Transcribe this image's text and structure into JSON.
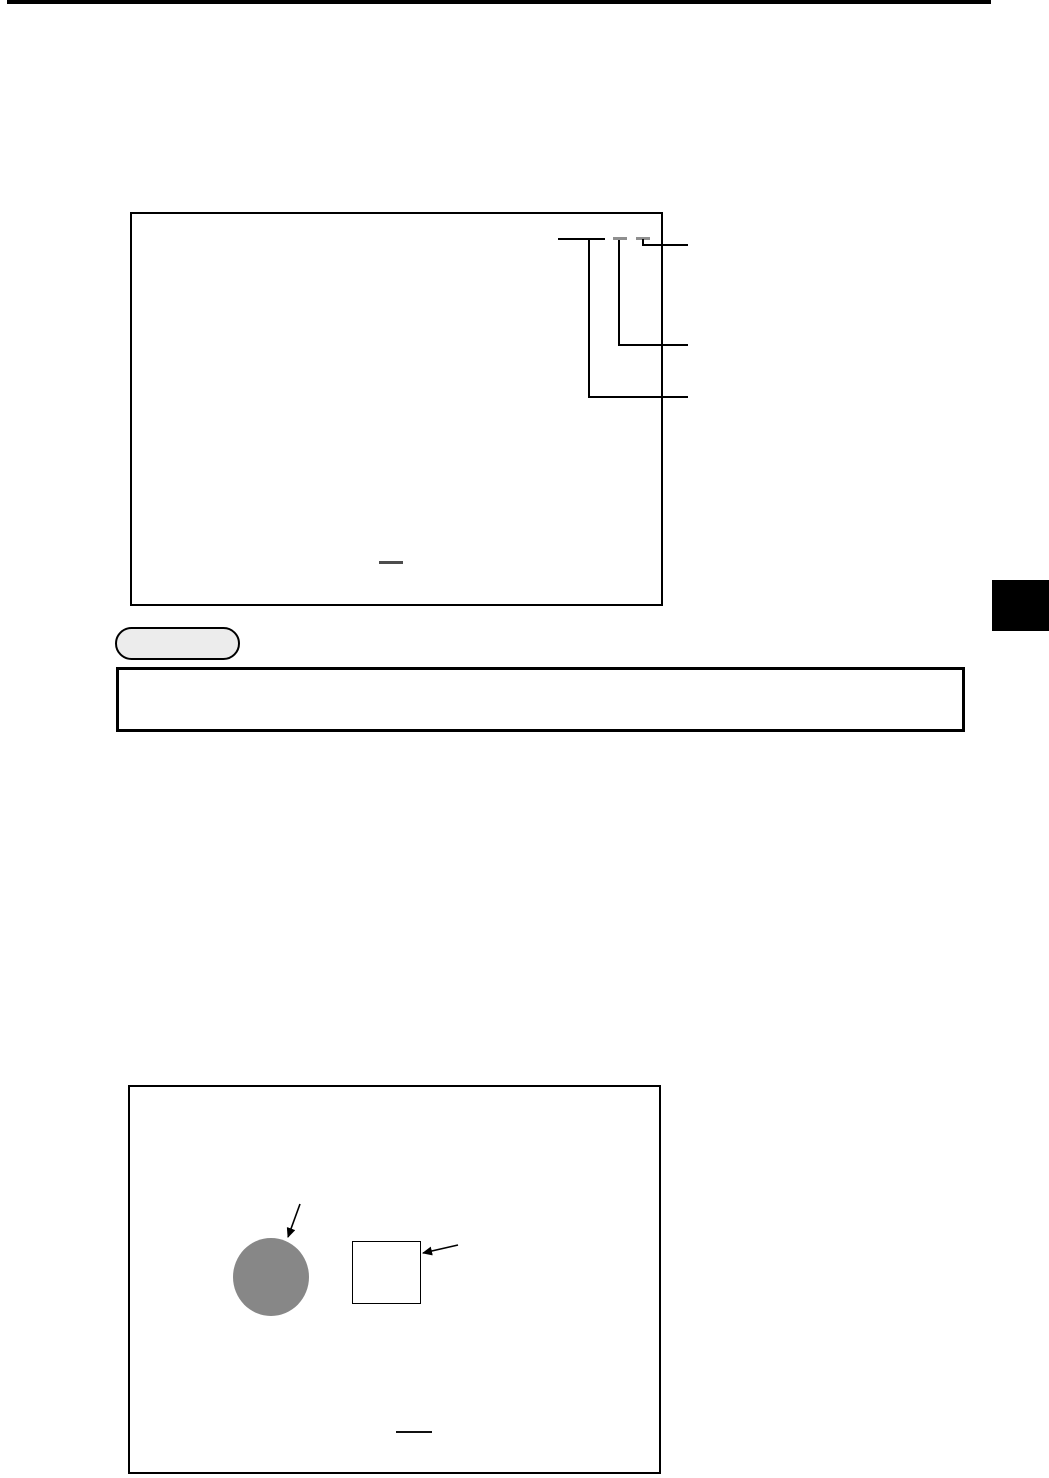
{
  "page": {
    "background": "#ffffff"
  },
  "colors": {
    "rule_black": "#000000",
    "figure_border": "#000000",
    "callout_line": "#000000",
    "label_line": "#000000",
    "redaction_grey": "#8f8f8f",
    "fig1_dash_dark": "#4d4d4d",
    "fig2_dash_black": "#111111",
    "pill_fill": "#ececec",
    "pill_border": "#000000",
    "note_box_border": "#000000",
    "chapter_tab_black": "#000000",
    "circle_fill": "#878787",
    "square_border": "#000000",
    "arrow_black": "#000000"
  },
  "icons": {
    "callout-arrow-icon": "thin diagonal line with solid triangular head",
    "redaction-dash-icon": "short grey horizontal bar (obscured label)",
    "chapter-tab-icon": "solid black rectangle bleeding off right page edge"
  },
  "figures": {
    "top_figure": {
      "callout_count": 3
    },
    "bottom_figure": {
      "shape_count": 2
    }
  }
}
